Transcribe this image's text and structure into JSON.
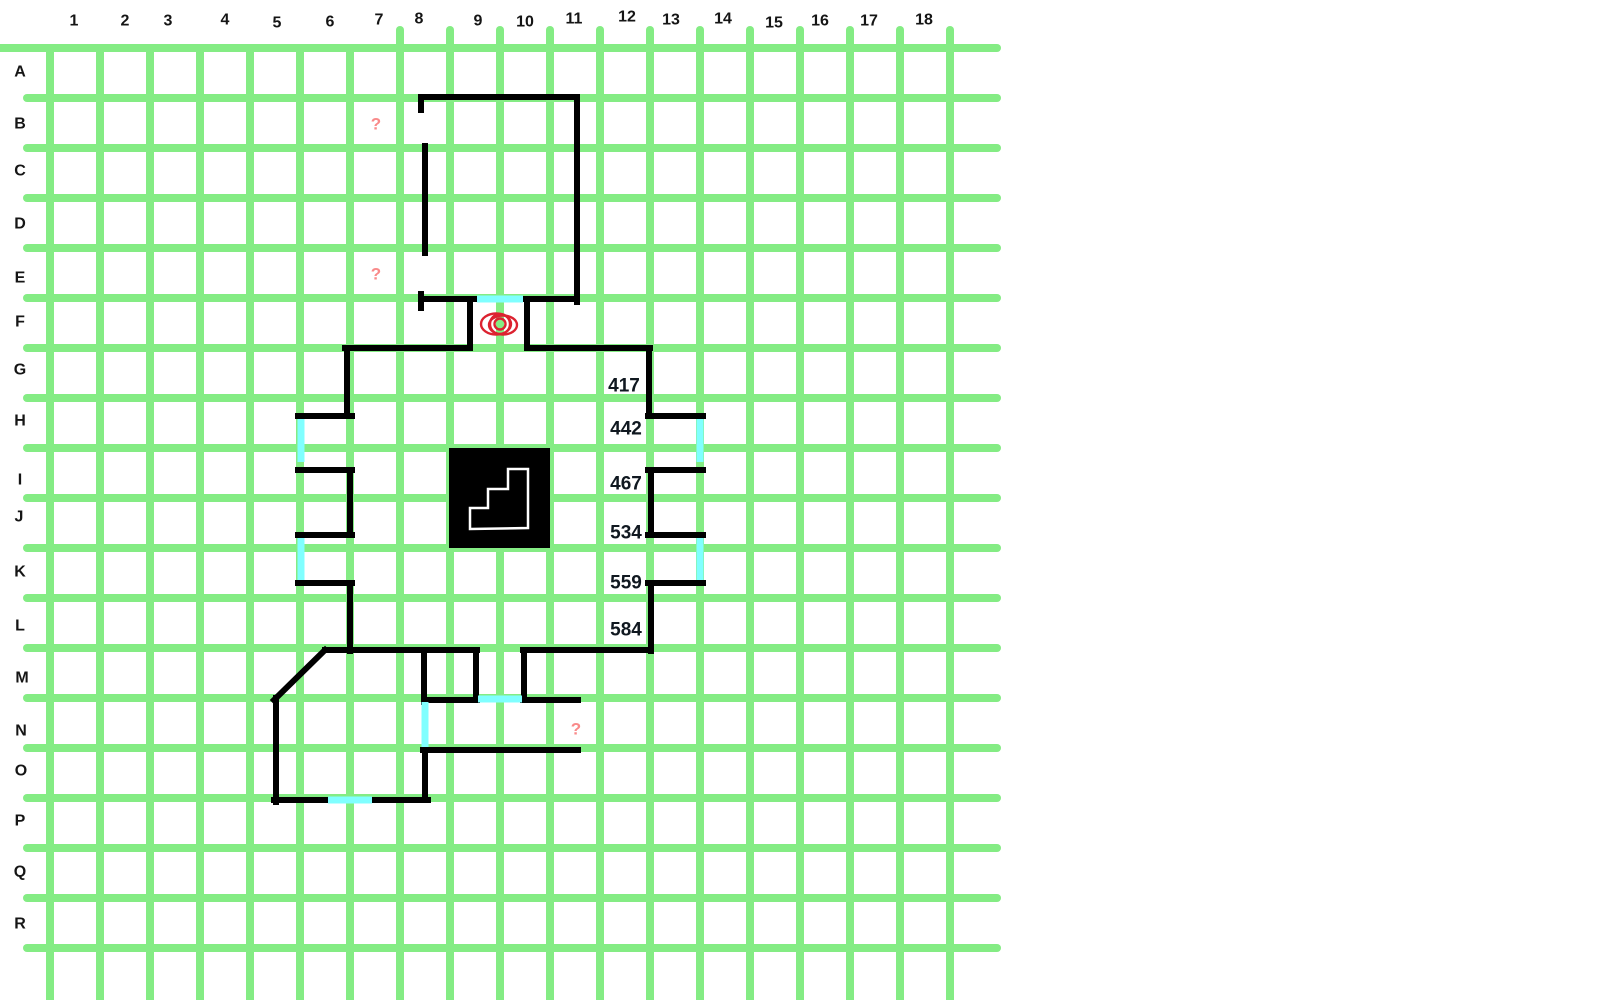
{
  "map": {
    "colors": {
      "grid": "#84EC84",
      "wall": "#000000",
      "door": "#80FFFF",
      "stairs_fill": "#000000",
      "stairs_outline": "#ffffff",
      "eye": "#DC2230",
      "question": "#F98A8A",
      "grid_label": "#151515",
      "room_number": "#101820"
    },
    "grid": {
      "cell_size": 50,
      "first_h_line_y": 48,
      "first_v_line_x": 50,
      "h_line_count": 19,
      "v_line_count": 19,
      "h_line_end_x": 997,
      "v_line_end_y": 1000,
      "column_labels": [
        {
          "text": "1",
          "x": 74,
          "y": 21
        },
        {
          "text": "2",
          "x": 125,
          "y": 21
        },
        {
          "text": "3",
          "x": 168,
          "y": 21
        },
        {
          "text": "4",
          "x": 225,
          "y": 20
        },
        {
          "text": "5",
          "x": 277,
          "y": 23
        },
        {
          "text": "6",
          "x": 330,
          "y": 22
        },
        {
          "text": "7",
          "x": 379,
          "y": 20
        },
        {
          "text": "8",
          "x": 419,
          "y": 19
        },
        {
          "text": "9",
          "x": 478,
          "y": 21
        },
        {
          "text": "10",
          "x": 525,
          "y": 22
        },
        {
          "text": "11",
          "x": 574,
          "y": 19
        },
        {
          "text": "12",
          "x": 627,
          "y": 17
        },
        {
          "text": "13",
          "x": 671,
          "y": 20
        },
        {
          "text": "14",
          "x": 723,
          "y": 19
        },
        {
          "text": "15",
          "x": 774,
          "y": 23
        },
        {
          "text": "16",
          "x": 820,
          "y": 21
        },
        {
          "text": "17",
          "x": 869,
          "y": 21
        },
        {
          "text": "18",
          "x": 924,
          "y": 20
        }
      ],
      "row_labels": [
        {
          "text": "A",
          "x": 20,
          "y": 72
        },
        {
          "text": "B",
          "x": 20,
          "y": 124
        },
        {
          "text": "C",
          "x": 20,
          "y": 171
        },
        {
          "text": "D",
          "x": 20,
          "y": 224
        },
        {
          "text": "E",
          "x": 20,
          "y": 278
        },
        {
          "text": "F",
          "x": 20,
          "y": 322
        },
        {
          "text": "G",
          "x": 20,
          "y": 370
        },
        {
          "text": "H",
          "x": 20,
          "y": 421
        },
        {
          "text": "I",
          "x": 20,
          "y": 480
        },
        {
          "text": "J",
          "x": 19,
          "y": 517
        },
        {
          "text": "K",
          "x": 20,
          "y": 572
        },
        {
          "text": "L",
          "x": 20,
          "y": 626
        },
        {
          "text": "M",
          "x": 22,
          "y": 678
        },
        {
          "text": "N",
          "x": 21,
          "y": 731
        },
        {
          "text": "O",
          "x": 21,
          "y": 771
        },
        {
          "text": "P",
          "x": 20,
          "y": 821
        },
        {
          "text": "Q",
          "x": 20,
          "y": 872
        },
        {
          "text": "R",
          "x": 20,
          "y": 924
        }
      ]
    },
    "walls": [
      [
        421,
        97,
        577,
        97
      ],
      [
        577,
        97,
        577,
        302
      ],
      [
        425,
        146,
        425,
        253
      ],
      [
        421,
        97,
        421,
        110
      ],
      [
        421,
        294,
        421,
        308
      ],
      [
        421,
        299,
        477,
        299
      ],
      [
        523,
        299,
        577,
        299
      ],
      [
        470,
        299,
        470,
        347
      ],
      [
        527,
        299,
        527,
        347
      ],
      [
        345,
        348,
        470,
        348
      ],
      [
        527,
        348,
        650,
        348
      ],
      [
        347,
        348,
        347,
        416
      ],
      [
        298,
        416,
        352,
        416
      ],
      [
        298,
        470,
        352,
        470
      ],
      [
        350,
        470,
        350,
        535
      ],
      [
        298,
        535,
        352,
        535
      ],
      [
        298,
        583,
        352,
        583
      ],
      [
        350,
        583,
        350,
        651
      ],
      [
        649,
        348,
        649,
        416
      ],
      [
        648,
        416,
        703,
        416
      ],
      [
        648,
        470,
        703,
        470
      ],
      [
        651,
        470,
        651,
        535
      ],
      [
        648,
        535,
        703,
        535
      ],
      [
        648,
        583,
        703,
        583
      ],
      [
        651,
        583,
        651,
        651
      ],
      [
        325,
        650,
        477,
        650
      ],
      [
        523,
        650,
        650,
        650
      ],
      [
        424,
        650,
        424,
        702
      ],
      [
        476,
        650,
        476,
        700
      ],
      [
        424,
        700,
        477,
        700
      ],
      [
        524,
        650,
        524,
        700
      ],
      [
        523,
        700,
        578,
        700
      ],
      [
        325,
        650,
        274,
        700
      ],
      [
        276,
        698,
        276,
        802
      ],
      [
        274,
        800,
        328,
        800
      ],
      [
        372,
        800,
        428,
        800
      ],
      [
        425,
        747,
        425,
        800
      ],
      [
        423,
        750,
        578,
        750
      ]
    ],
    "doors": [
      [
        477,
        299,
        523,
        299
      ],
      [
        301,
        419,
        301,
        462
      ],
      [
        301,
        538,
        301,
        580
      ],
      [
        700,
        419,
        700,
        462
      ],
      [
        700,
        538,
        700,
        580
      ],
      [
        478,
        699,
        522,
        699
      ],
      [
        425,
        702,
        425,
        747
      ],
      [
        328,
        800,
        372,
        800
      ]
    ],
    "stairs": {
      "rect": {
        "x": 449,
        "y": 448,
        "w": 101,
        "h": 100
      },
      "steps_points": "470,529 470,508 488,508 488,489 508,489 508,469 528,469 528,528 470,529"
    },
    "eye": {
      "cx": 500,
      "cy": 324,
      "ellipses": [
        {
          "cx": 496,
          "cy": 324,
          "rx": 15,
          "ry": 10.5
        },
        {
          "cx": 503,
          "cy": 325,
          "rx": 14,
          "ry": 9.5
        }
      ],
      "circles": [
        {
          "cx": 500,
          "cy": 324,
          "r": 10
        },
        {
          "cx": 500,
          "cy": 324,
          "r": 5.5
        }
      ]
    },
    "room_numbers": [
      {
        "text": "417",
        "x": 624,
        "y": 386
      },
      {
        "text": "442",
        "x": 626,
        "y": 429
      },
      {
        "text": "467",
        "x": 626,
        "y": 484
      },
      {
        "text": "534",
        "x": 626,
        "y": 533
      },
      {
        "text": "559",
        "x": 626,
        "y": 583
      },
      {
        "text": "584",
        "x": 626,
        "y": 630
      }
    ],
    "question_marks": [
      {
        "text": "?",
        "x": 376,
        "y": 124
      },
      {
        "text": "?",
        "x": 376,
        "y": 274
      },
      {
        "text": "?",
        "x": 576,
        "y": 729
      }
    ]
  }
}
